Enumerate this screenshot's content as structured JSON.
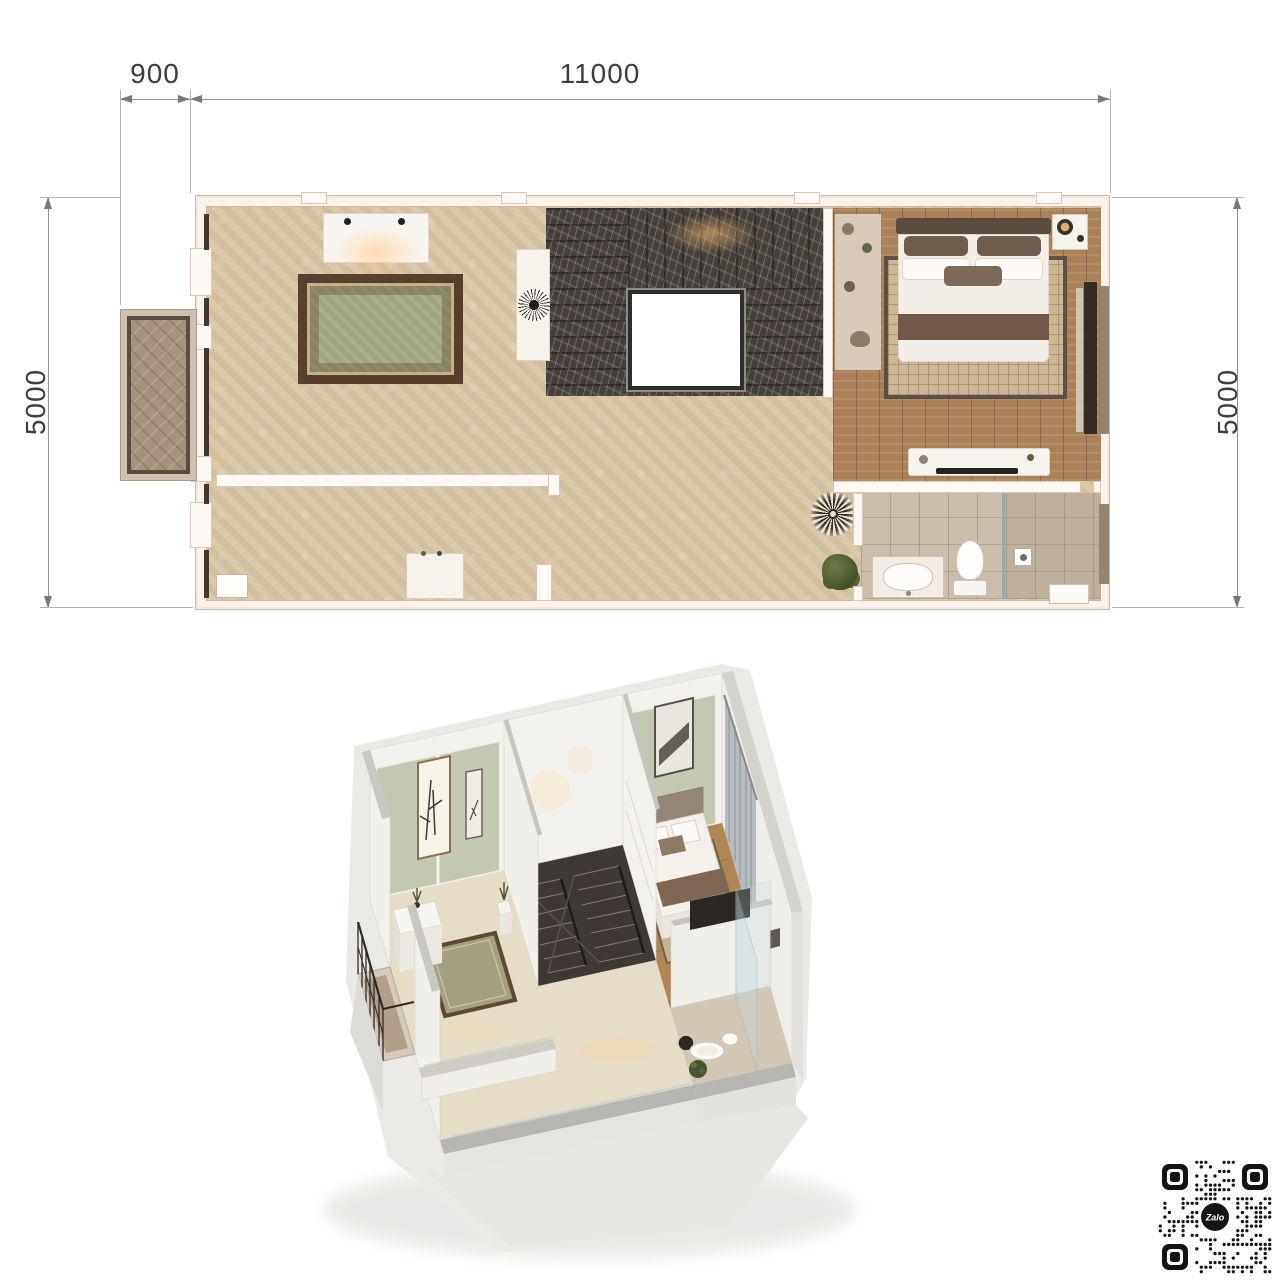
{
  "dimensions": {
    "top_offset": "900",
    "top_width": "11000",
    "side_left": "5000",
    "side_right": "5000"
  },
  "qr": {
    "label": "Zalo",
    "modules": 25
  },
  "colors": {
    "dim_line": "#8f8f8f",
    "dim_text": "#3d3d3d",
    "wall": "#f9f3ec",
    "wall_cut": "#b7b5b1",
    "carpet": "#d8c5a6",
    "wood": "#aa8157",
    "marble": "#46403a",
    "tile": "#cabdab",
    "green_panel": "#c3c8b3",
    "rug_green": "#9fa57e",
    "rug_border": "#563f2c",
    "dark_frame": "#45382e",
    "qr_ink": "#141414"
  }
}
